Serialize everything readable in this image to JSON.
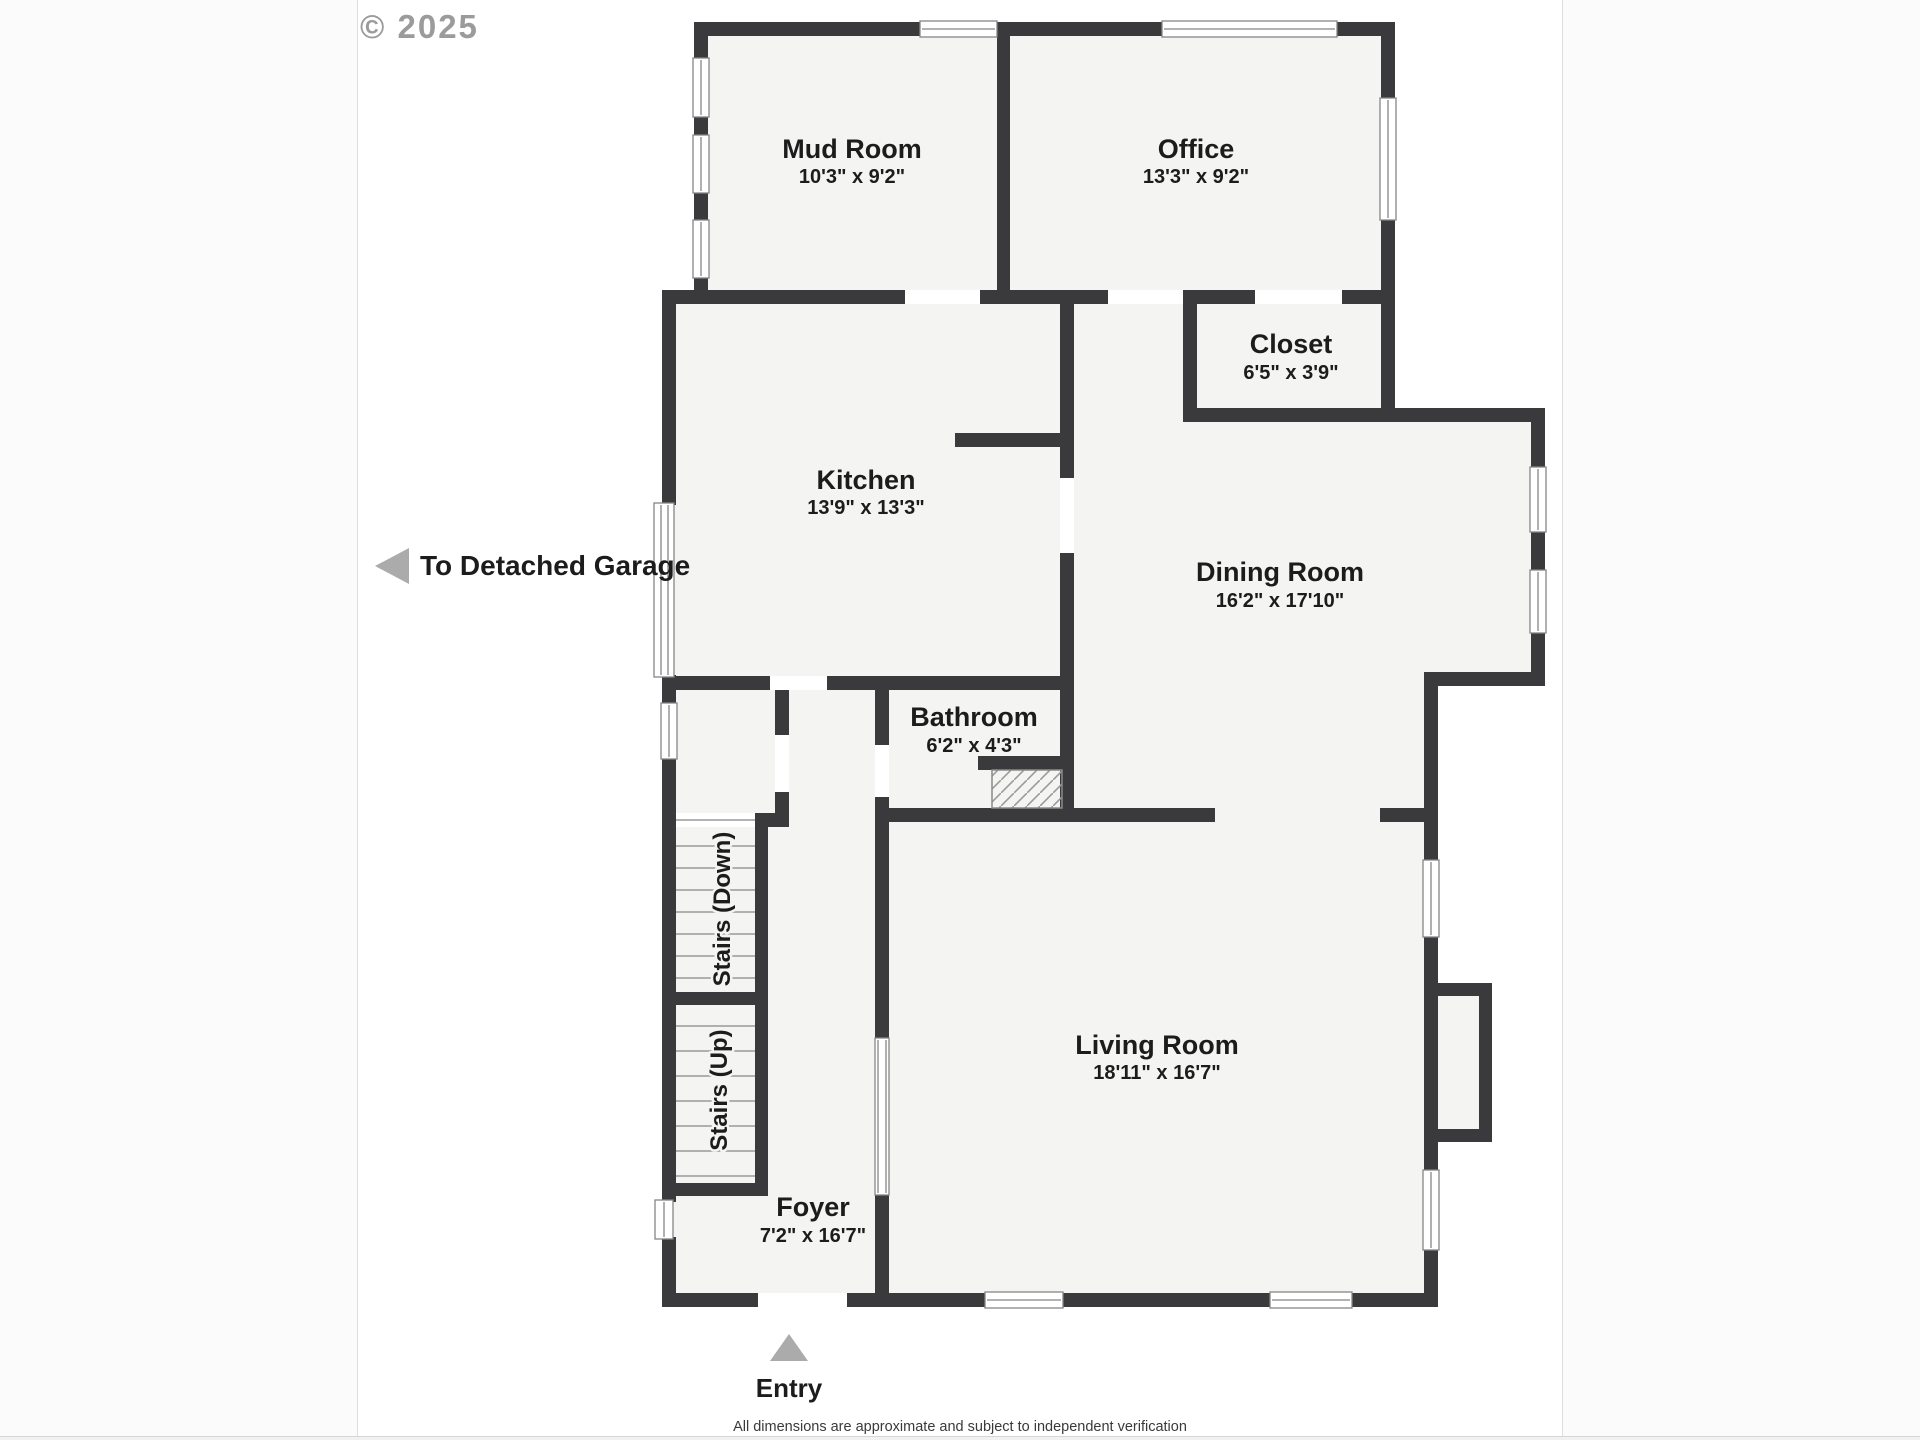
{
  "meta": {
    "watermark": "© 2025",
    "disclaimer": "All dimensions are approximate and subject to independent verification"
  },
  "annotations": {
    "garage_label": "To Detached Garage",
    "entry_label": "Entry"
  },
  "rooms": {
    "mud_room": {
      "name": "Mud Room",
      "dims": "10'3\" x 9'2\""
    },
    "office": {
      "name": "Office",
      "dims": "13'3\" x 9'2\""
    },
    "closet": {
      "name": "Closet",
      "dims": "6'5\" x 3'9\""
    },
    "kitchen": {
      "name": "Kitchen",
      "dims": "13'9\" x 13'3\""
    },
    "dining_room": {
      "name": "Dining Room",
      "dims": "16'2\" x 17'10\""
    },
    "bathroom": {
      "name": "Bathroom",
      "dims": "6'2\" x 4'3\""
    },
    "living_room": {
      "name": "Living Room",
      "dims": "18'11\" x 16'7\""
    },
    "foyer": {
      "name": "Foyer",
      "dims": "7'2\" x 16'7\""
    },
    "stairs_down": {
      "name": "Stairs (Down)"
    },
    "stairs_up": {
      "name": "Stairs (Up)"
    }
  },
  "colors": {
    "wall": "#3a3a3c",
    "floor": "#f4f4f3",
    "window_frame": "#858585",
    "arrow": "#ababab",
    "label_text": "#1c1c1c",
    "watermark_text": "#9b9b9b"
  }
}
